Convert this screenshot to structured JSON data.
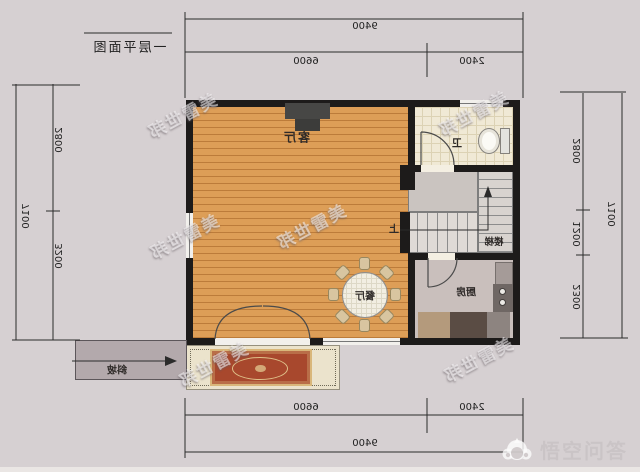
{
  "title": {
    "text": "一层平面图"
  },
  "rooms": {
    "living": "客厅",
    "dining": "餐厅",
    "kitchen": "厨房",
    "stairs": "楼梯",
    "bathroom": "卫",
    "up": "上",
    "ramp": "斜坡"
  },
  "dimensions": {
    "top": {
      "total": "9400",
      "left_segment": "6600",
      "right_segment": "2400"
    },
    "bottom": {
      "total": "9400",
      "left_segment": "6600",
      "right_segment": "2400"
    },
    "left": {
      "total": "7100",
      "upper": "2800",
      "lower": "3200"
    },
    "right": {
      "total": "7100",
      "upper": "2800",
      "middle": "1200",
      "lower": "2300"
    }
  },
  "watermark": {
    "text": "美雷世邦"
  },
  "logo": {
    "text": "悟空问答"
  },
  "colors": {
    "background": "#d6d0d2",
    "wall": "#1d1b1a",
    "wood_floor": "#dd9e57",
    "tile_floor": "#f0e9d5",
    "kitchen_floor": "#c9bfbc",
    "rug": "#a8482d",
    "rug_border": "#d9b77a",
    "porch": "#ebe3cc",
    "ramp": "#b3a9ac",
    "dimension_line": "#2b2b2b"
  },
  "note_orientation": "plan image is horizontally mirrored; logo is not"
}
